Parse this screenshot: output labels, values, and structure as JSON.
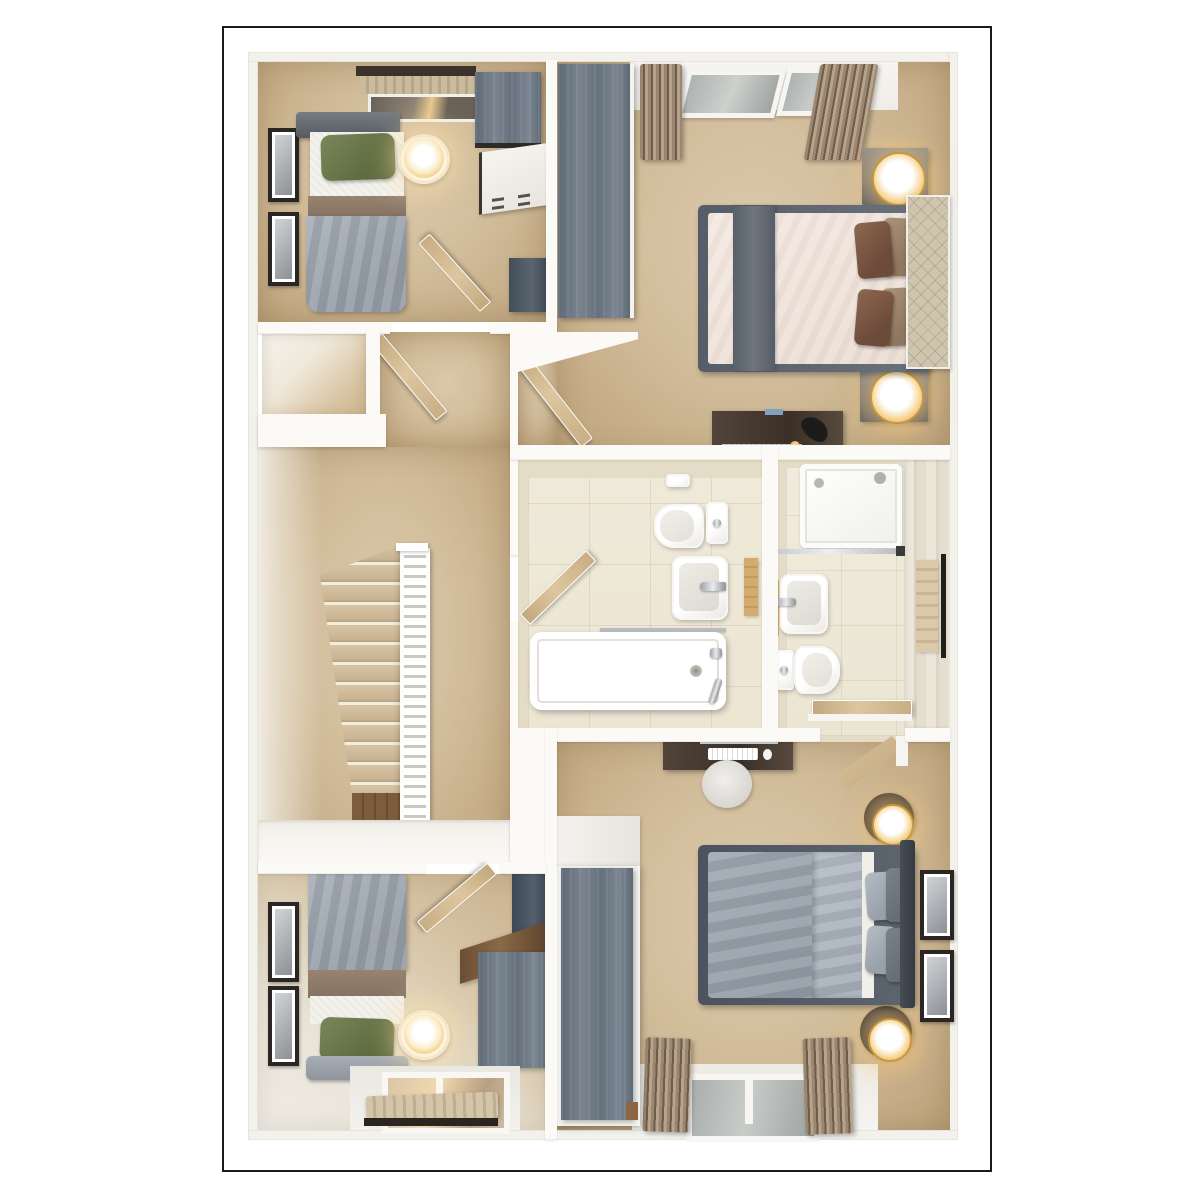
{
  "scene": {
    "description": "3D rendered top-down dollhouse floor plan of an upper storey with four bedrooms, a landing with staircase, a family bathroom and a shower room",
    "rooms": [
      {
        "id": "bedroom-top-left",
        "label": "single bedroom with green pillow bed, wall art, lamp, dresser and wardrobe cabinet"
      },
      {
        "id": "master-bedroom",
        "label": "master bedroom with double bed, brown cushions, wardrobe, two nightstand lamps, desk and curtained windows"
      },
      {
        "id": "landing",
        "label": "carpeted landing with staircase, white banister and open doors"
      },
      {
        "id": "bathroom",
        "label": "family bathroom with bathtub, basin and toilet"
      },
      {
        "id": "shower-room",
        "label": "shower room with shower tray, basin, toilet and towel rail"
      },
      {
        "id": "bedroom-bottom-right",
        "label": "double bedroom with gray bed, desk with keyboard, round rug, lamps and curtained window"
      },
      {
        "id": "bedroom-bottom-left",
        "label": "single bedroom with green pillow bed, desk and curtained window"
      }
    ],
    "furniture": [
      "single-bed",
      "double-bed",
      "wardrobe",
      "dresser",
      "nightstand",
      "table-lamp",
      "desk",
      "keyboard",
      "mouse",
      "picture-frame",
      "curtains",
      "window",
      "staircase",
      "banister",
      "bathtub",
      "toilet",
      "sink",
      "shower-tray",
      "towel-rail",
      "door",
      "rug"
    ]
  },
  "colors": {
    "frame_border": "#1a1a1a",
    "wall": "#fbfaf7",
    "carpet": "#d2bd9b",
    "tile_floor": "#efe9d9",
    "wall_tile": "#e5dcc7",
    "wardrobe_blue_gray": "#6a7480",
    "wood_dark": "#4a3b30",
    "wood_light_door": "#cdb592",
    "duvet_gray": "#9aa2ab",
    "duvet_cream": "#f2e7e0",
    "runner_gray": "#5d6670",
    "pillow_green": "#6d7a4d",
    "pillow_brown": "#7c5743",
    "curtain_brown": "#8f7b66",
    "lamp_glow": "#f5c878",
    "banister_white": "#ffffff"
  }
}
